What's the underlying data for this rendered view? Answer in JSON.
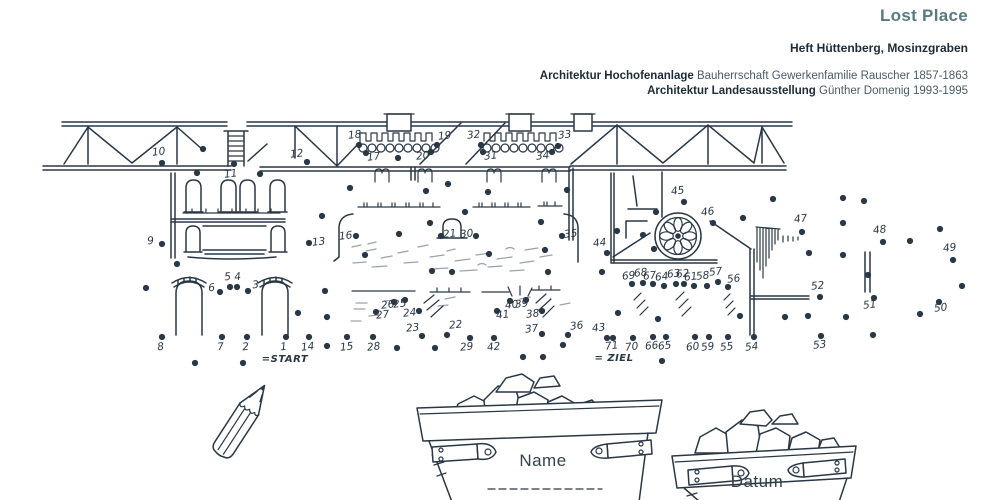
{
  "page": {
    "background": "#ffffff",
    "ink": "#2a3744",
    "accent": "#587a80"
  },
  "header": {
    "title": "Lost Place",
    "subtitle": "Heft Hüttenberg, Mosinzgraben",
    "credits": [
      {
        "bold": "Architektur Hochofenanlage",
        "text": " Bauherrschaft Gewerkenfamilie Rauscher 1857-1863"
      },
      {
        "bold": "Architektur Landesausstellung",
        "text": " Günther Domenig 1993-1995"
      }
    ]
  },
  "puzzle": {
    "type": "connect-the-dots",
    "subject": "Hochofenanlage Heft (blast-furnace ruins) line drawing",
    "start_label": "=START",
    "ziel_label": "= ZIEL",
    "dot_count": 71,
    "dots_format": [
      "number",
      "dot_x",
      "dot_y",
      "label_x",
      "label_y"
    ],
    "dots": [
      [
        1,
        286,
        337,
        284,
        350
      ],
      [
        2,
        247,
        337,
        246,
        350
      ],
      [
        3,
        248,
        291,
        256,
        288
      ],
      [
        4,
        237,
        287,
        238,
        280
      ],
      [
        5,
        230,
        287,
        228,
        280
      ],
      [
        6,
        220,
        292,
        212,
        291
      ],
      [
        7,
        222,
        337,
        221,
        350
      ],
      [
        8,
        162,
        337,
        161,
        350
      ],
      [
        9,
        162,
        244,
        151,
        244
      ],
      [
        10,
        162,
        163,
        159,
        155
      ],
      [
        11,
        234,
        164,
        231,
        177
      ],
      [
        12,
        307,
        162,
        297,
        157
      ],
      [
        13,
        309,
        243,
        319,
        245
      ],
      [
        14,
        309,
        337,
        308,
        350
      ],
      [
        15,
        347,
        337,
        347,
        350
      ],
      [
        16,
        356,
        236,
        346,
        239
      ],
      [
        17,
        366,
        153,
        374,
        160
      ],
      [
        18,
        359,
        145,
        355,
        138
      ],
      [
        19,
        437,
        145,
        445,
        139
      ],
      [
        20,
        431,
        152,
        423,
        159
      ],
      [
        21,
        441,
        236,
        450,
        237
      ],
      [
        22,
        447,
        335,
        456,
        328
      ],
      [
        23,
        422,
        336,
        413,
        331
      ],
      [
        24,
        419,
        311,
        410,
        316
      ],
      [
        25,
        405,
        300,
        400,
        307
      ],
      [
        26,
        394,
        302,
        388,
        308
      ],
      [
        27,
        376,
        312,
        383,
        318
      ],
      [
        28,
        373,
        337,
        374,
        350
      ],
      [
        29,
        470,
        338,
        467,
        350
      ],
      [
        30,
        476,
        236,
        467,
        237
      ],
      [
        31,
        483,
        152,
        491,
        159
      ],
      [
        32,
        481,
        145,
        474,
        138
      ],
      [
        33,
        558,
        146,
        565,
        138
      ],
      [
        34,
        552,
        152,
        543,
        159
      ],
      [
        35,
        562,
        236,
        571,
        237
      ],
      [
        36,
        568,
        335,
        577,
        329
      ],
      [
        37,
        542,
        334,
        532,
        332
      ],
      [
        38,
        542,
        311,
        533,
        317
      ],
      [
        39,
        526,
        300,
        522,
        307
      ],
      [
        40,
        510,
        301,
        512,
        308
      ],
      [
        41,
        497,
        311,
        503,
        318
      ],
      [
        42,
        494,
        338,
        494,
        350
      ],
      [
        43,
        607,
        338,
        599,
        331
      ],
      [
        44,
        607,
        253,
        600,
        246
      ],
      [
        45,
        684,
        202,
        678,
        194
      ],
      [
        46,
        713,
        223,
        708,
        215
      ],
      [
        47,
        802,
        232,
        801,
        222
      ],
      [
        48,
        883,
        242,
        880,
        233
      ],
      [
        49,
        953,
        260,
        950,
        251
      ],
      [
        50,
        939,
        302,
        941,
        311
      ],
      [
        51,
        874,
        298,
        870,
        308
      ],
      [
        52,
        820,
        297,
        818,
        289
      ],
      [
        53,
        821,
        336,
        820,
        348
      ],
      [
        54,
        754,
        337,
        752,
        350
      ],
      [
        55,
        728,
        337,
        727,
        350
      ],
      [
        56,
        728,
        287,
        734,
        282
      ],
      [
        57,
        718,
        282,
        716,
        275
      ],
      [
        58,
        707,
        286,
        703,
        279
      ],
      [
        59,
        709,
        337,
        708,
        350
      ],
      [
        60,
        695,
        337,
        693,
        350
      ],
      [
        61,
        694,
        286,
        691,
        280
      ],
      [
        62,
        684,
        284,
        683,
        277
      ],
      [
        63,
        676,
        284,
        674,
        277
      ],
      [
        64,
        664,
        286,
        662,
        280
      ],
      [
        65,
        666,
        337,
        665,
        349
      ],
      [
        66,
        653,
        337,
        652,
        349
      ],
      [
        67,
        653,
        284,
        650,
        279
      ],
      [
        68,
        643,
        283,
        641,
        276
      ],
      [
        69,
        632,
        284,
        629,
        279
      ],
      [
        70,
        633,
        338,
        632,
        350
      ],
      [
        71,
        613,
        338,
        612,
        349
      ]
    ],
    "extra_dots": [
      [
        197,
        173
      ],
      [
        260,
        174
      ],
      [
        203,
        149
      ],
      [
        322,
        216
      ],
      [
        177,
        264
      ],
      [
        146,
        288
      ],
      [
        298,
        313
      ],
      [
        327,
        317
      ],
      [
        325,
        291
      ],
      [
        327,
        346
      ],
      [
        195,
        363
      ],
      [
        243,
        363
      ],
      [
        350,
        188
      ],
      [
        398,
        158
      ],
      [
        426,
        191
      ],
      [
        448,
        184
      ],
      [
        488,
        192
      ],
      [
        567,
        190
      ],
      [
        465,
        212
      ],
      [
        541,
        222
      ],
      [
        399,
        234
      ],
      [
        430,
        223
      ],
      [
        545,
        250
      ],
      [
        365,
        255
      ],
      [
        432,
        271
      ],
      [
        452,
        272
      ],
      [
        489,
        254
      ],
      [
        548,
        272
      ],
      [
        397,
        348
      ],
      [
        435,
        348
      ],
      [
        523,
        357
      ],
      [
        543,
        357
      ],
      [
        563,
        345
      ],
      [
        662,
        361
      ],
      [
        643,
        235
      ],
      [
        617,
        231
      ],
      [
        654,
        249
      ],
      [
        656,
        212
      ],
      [
        618,
        313
      ],
      [
        658,
        319
      ],
      [
        602,
        272
      ],
      [
        773,
        199
      ],
      [
        843,
        198
      ],
      [
        864,
        201
      ],
      [
        743,
        218
      ],
      [
        843,
        223
      ],
      [
        940,
        229
      ],
      [
        910,
        241
      ],
      [
        809,
        253
      ],
      [
        843,
        255
      ],
      [
        868,
        275
      ],
      [
        962,
        286
      ],
      [
        740,
        316
      ],
      [
        785,
        317
      ],
      [
        808,
        316
      ],
      [
        846,
        317
      ],
      [
        920,
        314
      ],
      [
        873,
        335
      ]
    ]
  },
  "fields": {
    "name_label": "Name",
    "datum_label": "Datum"
  }
}
